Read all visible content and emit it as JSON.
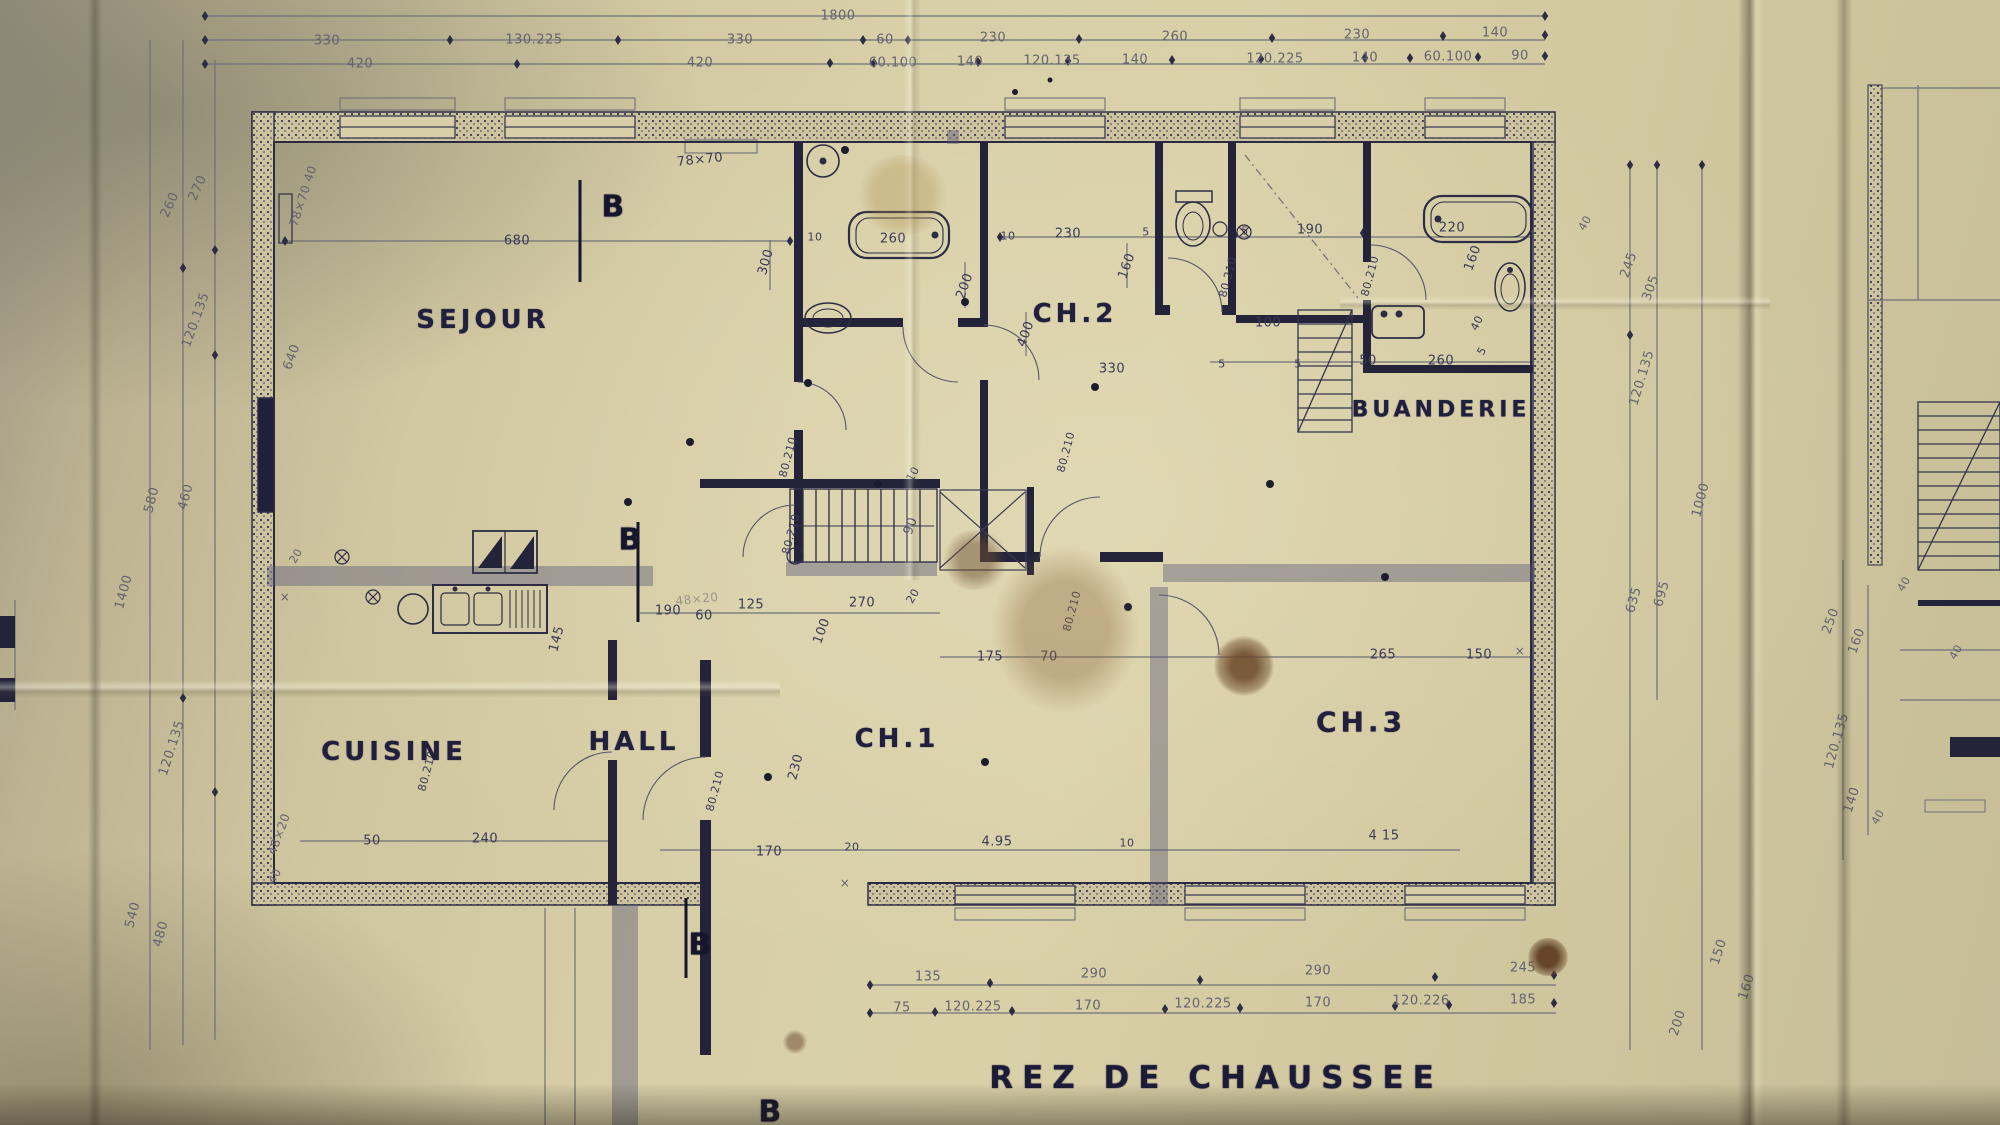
{
  "plan": {
    "title": {
      "t": "REZ DE CHAUSSEE",
      "x": 1216,
      "y": 1078
    },
    "room_labels": [
      {
        "t": "SEJOUR",
        "x": 483,
        "y": 320
      },
      {
        "t": "CH.2",
        "x": 1075,
        "y": 314
      },
      {
        "t": "BUANDERIE",
        "x": 1441,
        "y": 410,
        "s": 22
      },
      {
        "t": "CUISINE",
        "x": 394,
        "y": 752
      },
      {
        "t": "HALL",
        "x": 634,
        "y": 742
      },
      {
        "t": "CH.1",
        "x": 897,
        "y": 739
      },
      {
        "t": "CH.3",
        "x": 1361,
        "y": 722,
        "s": 28
      }
    ],
    "section_markers": [
      {
        "t": "B",
        "x": 613,
        "y": 207
      },
      {
        "t": "B",
        "x": 630,
        "y": 540
      },
      {
        "t": "B",
        "x": 700,
        "y": 945
      },
      {
        "t": "B",
        "x": 770,
        "y": 1112
      }
    ],
    "top_chain": [
      {
        "t": "1800",
        "x": 838,
        "y": 16
      },
      {
        "t": "330",
        "x": 327,
        "y": 41
      },
      {
        "t": "130.225",
        "x": 534,
        "y": 40
      },
      {
        "t": "330",
        "x": 740,
        "y": 40
      },
      {
        "t": "60",
        "x": 885,
        "y": 40
      },
      {
        "t": "230",
        "x": 993,
        "y": 38
      },
      {
        "t": "260",
        "x": 1175,
        "y": 37
      },
      {
        "t": "230",
        "x": 1357,
        "y": 35
      },
      {
        "t": "140",
        "x": 1495,
        "y": 33
      },
      {
        "t": "420",
        "x": 360,
        "y": 64
      },
      {
        "t": "420",
        "x": 700,
        "y": 63
      },
      {
        "t": "60.100",
        "x": 893,
        "y": 63
      },
      {
        "t": "140",
        "x": 970,
        "y": 62
      },
      {
        "t": "120.135",
        "x": 1052,
        "y": 61
      },
      {
        "t": "140",
        "x": 1135,
        "y": 60
      },
      {
        "t": "120.225",
        "x": 1275,
        "y": 59
      },
      {
        "t": "140",
        "x": 1365,
        "y": 58
      },
      {
        "t": "60.100",
        "x": 1448,
        "y": 57
      },
      {
        "t": "90",
        "x": 1520,
        "y": 56
      }
    ],
    "left_chain": [
      {
        "t": "260",
        "x": 170,
        "y": 205,
        "r": -65
      },
      {
        "t": "270",
        "x": 198,
        "y": 188,
        "r": -65
      },
      {
        "t": "120.135",
        "x": 196,
        "y": 320,
        "r": -70
      },
      {
        "t": "580",
        "x": 152,
        "y": 500,
        "r": -75
      },
      {
        "t": "460",
        "x": 186,
        "y": 497,
        "r": -75
      },
      {
        "t": "1400",
        "x": 124,
        "y": 592,
        "r": -75
      },
      {
        "t": "120.135",
        "x": 172,
        "y": 748,
        "r": -72
      },
      {
        "t": "540",
        "x": 133,
        "y": 915,
        "r": -75
      },
      {
        "t": "480",
        "x": 161,
        "y": 934,
        "r": -75
      },
      {
        "t": "48×20",
        "x": 279,
        "y": 834,
        "r": -70,
        "s": 12
      },
      {
        "t": "40",
        "x": 275,
        "y": 876,
        "r": -60,
        "s": 11
      },
      {
        "t": "78×70 40",
        "x": 303,
        "y": 196,
        "r": -72,
        "s": 12
      },
      {
        "t": "640",
        "x": 292,
        "y": 357,
        "r": -70
      },
      {
        "t": "20",
        "x": 296,
        "y": 556,
        "r": -60,
        "s": 11
      }
    ],
    "right_chain": [
      {
        "t": "40",
        "x": 1585,
        "y": 223,
        "r": -60,
        "s": 11
      },
      {
        "t": "245",
        "x": 1629,
        "y": 265,
        "r": -70
      },
      {
        "t": "305",
        "x": 1651,
        "y": 288,
        "r": -70
      },
      {
        "t": "120.135",
        "x": 1642,
        "y": 378,
        "r": -73
      },
      {
        "t": "1000",
        "x": 1701,
        "y": 500,
        "r": -75
      },
      {
        "t": "695",
        "x": 1662,
        "y": 594,
        "r": -74
      },
      {
        "t": "635",
        "x": 1634,
        "y": 600,
        "r": -74
      },
      {
        "t": "250",
        "x": 1831,
        "y": 621,
        "r": -70
      },
      {
        "t": "160",
        "x": 1857,
        "y": 641,
        "r": -70
      },
      {
        "t": "120.135",
        "x": 1837,
        "y": 741,
        "r": -74
      },
      {
        "t": "140",
        "x": 1852,
        "y": 800,
        "r": -72
      },
      {
        "t": "40",
        "x": 1878,
        "y": 817,
        "r": -60,
        "s": 11
      },
      {
        "t": "150",
        "x": 1719,
        "y": 952,
        "r": -72
      },
      {
        "t": "160",
        "x": 1747,
        "y": 987,
        "r": -72
      },
      {
        "t": "200",
        "x": 1678,
        "y": 1023,
        "r": -72
      },
      {
        "t": "40",
        "x": 1904,
        "y": 584,
        "r": -60,
        "s": 11
      },
      {
        "t": "40",
        "x": 1956,
        "y": 652,
        "r": -60,
        "s": 11
      }
    ],
    "bottom_chain": [
      {
        "t": "135",
        "x": 928,
        "y": 977
      },
      {
        "t": "290",
        "x": 1094,
        "y": 974
      },
      {
        "t": "290",
        "x": 1318,
        "y": 971
      },
      {
        "t": "245",
        "x": 1523,
        "y": 968
      },
      {
        "t": "75",
        "x": 902,
        "y": 1008
      },
      {
        "t": "120.225",
        "x": 973,
        "y": 1007
      },
      {
        "t": "170",
        "x": 1088,
        "y": 1006
      },
      {
        "t": "120.225",
        "x": 1203,
        "y": 1004
      },
      {
        "t": "170",
        "x": 1318,
        "y": 1003
      },
      {
        "t": "120.226",
        "x": 1421,
        "y": 1001
      },
      {
        "t": "185",
        "x": 1523,
        "y": 1000
      }
    ],
    "interior": [
      {
        "t": "680",
        "x": 517,
        "y": 241
      },
      {
        "t": "78×70",
        "x": 700,
        "y": 160,
        "r": -6
      },
      {
        "t": "300",
        "x": 766,
        "y": 262,
        "r": -74
      },
      {
        "t": "10",
        "x": 815,
        "y": 237,
        "s": 11
      },
      {
        "t": "260",
        "x": 893,
        "y": 239
      },
      {
        "t": "10",
        "x": 1008,
        "y": 236,
        "s": 11
      },
      {
        "t": "230",
        "x": 1068,
        "y": 234
      },
      {
        "t": "5",
        "x": 1146,
        "y": 232,
        "s": 11
      },
      {
        "t": "5",
        "x": 1245,
        "y": 231,
        "s": 11
      },
      {
        "t": "190",
        "x": 1310,
        "y": 230
      },
      {
        "t": "220",
        "x": 1452,
        "y": 228
      },
      {
        "t": "160",
        "x": 1127,
        "y": 266,
        "r": -70
      },
      {
        "t": "200",
        "x": 965,
        "y": 286,
        "r": -70
      },
      {
        "t": "400",
        "x": 1026,
        "y": 334,
        "r": -70
      },
      {
        "t": "330",
        "x": 1112,
        "y": 369
      },
      {
        "t": "100",
        "x": 1268,
        "y": 323
      },
      {
        "t": "160",
        "x": 1473,
        "y": 258,
        "r": -70
      },
      {
        "t": "40",
        "x": 1477,
        "y": 323,
        "r": -64,
        "s": 11
      },
      {
        "t": "5",
        "x": 1482,
        "y": 351,
        "r": -60,
        "s": 11
      },
      {
        "t": "260",
        "x": 1441,
        "y": 361
      },
      {
        "t": "5",
        "x": 1222,
        "y": 364,
        "s": 11
      },
      {
        "t": "5",
        "x": 1298,
        "y": 364,
        "s": 11
      },
      {
        "t": "50",
        "x": 1368,
        "y": 361
      },
      {
        "t": "80.210",
        "x": 1228,
        "y": 277,
        "r": -75,
        "s": 11
      },
      {
        "t": "80.210",
        "x": 1370,
        "y": 276,
        "r": -75,
        "s": 11
      },
      {
        "t": "90",
        "x": 911,
        "y": 526,
        "r": -70
      },
      {
        "t": "10",
        "x": 913,
        "y": 474,
        "r": -60,
        "s": 11
      },
      {
        "t": "80.210",
        "x": 788,
        "y": 457,
        "r": -75,
        "s": 11
      },
      {
        "t": "80.210",
        "x": 791,
        "y": 534,
        "r": -75,
        "s": 11
      },
      {
        "t": "20",
        "x": 913,
        "y": 596,
        "r": -60,
        "s": 11
      },
      {
        "t": "270",
        "x": 862,
        "y": 603
      },
      {
        "t": "125",
        "x": 751,
        "y": 605
      },
      {
        "t": "100",
        "x": 822,
        "y": 631,
        "r": -70
      },
      {
        "t": "190",
        "x": 668,
        "y": 611
      },
      {
        "t": "60",
        "x": 704,
        "y": 616
      },
      {
        "t": "48×20",
        "x": 697,
        "y": 599,
        "r": -6,
        "s": 12,
        "c": "pencil faint"
      },
      {
        "t": "145",
        "x": 557,
        "y": 639,
        "r": -75
      },
      {
        "t": "175",
        "x": 990,
        "y": 657
      },
      {
        "t": "70",
        "x": 1049,
        "y": 657
      },
      {
        "t": "265",
        "x": 1383,
        "y": 655
      },
      {
        "t": "150",
        "x": 1479,
        "y": 655
      },
      {
        "t": "80.210",
        "x": 1066,
        "y": 452,
        "r": -75,
        "s": 11
      },
      {
        "t": "80.210",
        "x": 1072,
        "y": 611,
        "r": -75,
        "s": 11
      },
      {
        "t": "80.210",
        "x": 715,
        "y": 791,
        "r": -75,
        "s": 11
      },
      {
        "t": "230",
        "x": 796,
        "y": 767,
        "r": -75
      },
      {
        "t": "170",
        "x": 769,
        "y": 852
      },
      {
        "t": "20",
        "x": 852,
        "y": 847,
        "s": 11
      },
      {
        "t": "4.95",
        "x": 997,
        "y": 842
      },
      {
        "t": "10",
        "x": 1127,
        "y": 843,
        "s": 11
      },
      {
        "t": "4 15",
        "x": 1384,
        "y": 836
      },
      {
        "t": "50",
        "x": 372,
        "y": 841
      },
      {
        "t": "240",
        "x": 485,
        "y": 839
      },
      {
        "t": "80.210",
        "x": 427,
        "y": 771,
        "r": -75,
        "s": 11
      },
      {
        "t": "×",
        "x": 285,
        "y": 597,
        "s": 12,
        "c": "pencil"
      },
      {
        "t": "×",
        "x": 845,
        "y": 883,
        "s": 12,
        "c": "pencil"
      },
      {
        "t": "×",
        "x": 1520,
        "y": 651,
        "s": 12,
        "c": "pencil"
      }
    ],
    "accent_colors": {
      "ink": "#33334e",
      "pencil": "#70707a",
      "paper": "#d8cfa8",
      "stain": "#7b5a3a"
    }
  }
}
